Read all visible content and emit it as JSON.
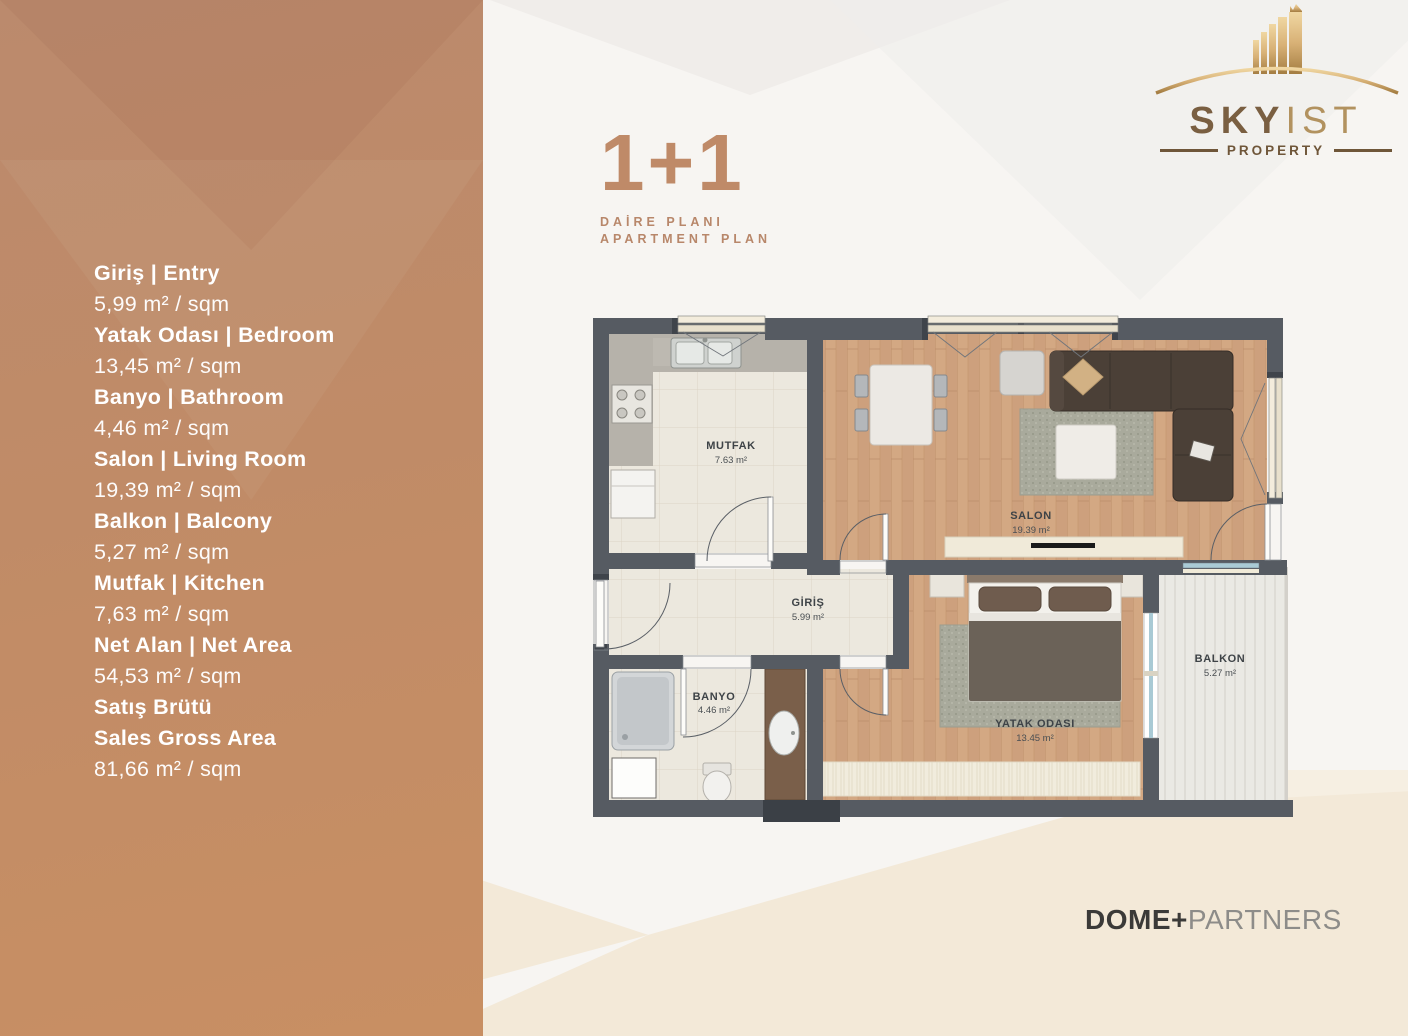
{
  "title": {
    "heading": "1+1",
    "subtitle_line1": "DAİRE PLANI",
    "subtitle_line2": "APARTMENT PLAN"
  },
  "logo": {
    "brand_primary": "SKY",
    "brand_secondary": "IST",
    "tagline": "PROPERTY"
  },
  "footer": {
    "brand_bold": "DOME+",
    "brand_light": "PARTNERS"
  },
  "sidebar": {
    "specs": [
      {
        "label": "Giriş | Entry",
        "value": "5,99 m² / sqm"
      },
      {
        "label": "Yatak Odası | Bedroom",
        "value": "13,45 m² / sqm"
      },
      {
        "label": "Banyo | Bathroom",
        "value": "4,46 m² / sqm"
      },
      {
        "label": "Salon | Living Room",
        "value": "19,39 m² / sqm"
      },
      {
        "label": "Balkon | Balcony",
        "value": "5,27 m² / sqm"
      },
      {
        "label": "Mutfak | Kitchen",
        "value": "7,63 m² / sqm"
      },
      {
        "label": "Net Alan | Net Area",
        "value": "54,53 m² / sqm"
      },
      {
        "label": "Satış Brütü",
        "label2": "Sales Gross Area",
        "value": "81,66 m² / sqm"
      }
    ]
  },
  "floor_plan": {
    "rooms": [
      {
        "name": "MUTFAK",
        "area": "7.63 m²"
      },
      {
        "name": "SALON",
        "area": "19.39 m²"
      },
      {
        "name": "GİRİŞ",
        "area": "5.99 m²"
      },
      {
        "name": "BANYO",
        "area": "4.46 m²"
      },
      {
        "name": "YATAK ODASI",
        "area": "13.45 m²"
      },
      {
        "name": "BALKON",
        "area": "5.27 m²"
      }
    ]
  },
  "colors": {
    "sidebar_terracotta": "#c18c66",
    "accent_terracotta": "#bf8a68",
    "logo_gold": "#b5935f",
    "wall_gray": "#565b62",
    "wood_floor": "#cda07d",
    "footer_dark": "#3b3a38",
    "footer_light": "#8d8c89"
  }
}
